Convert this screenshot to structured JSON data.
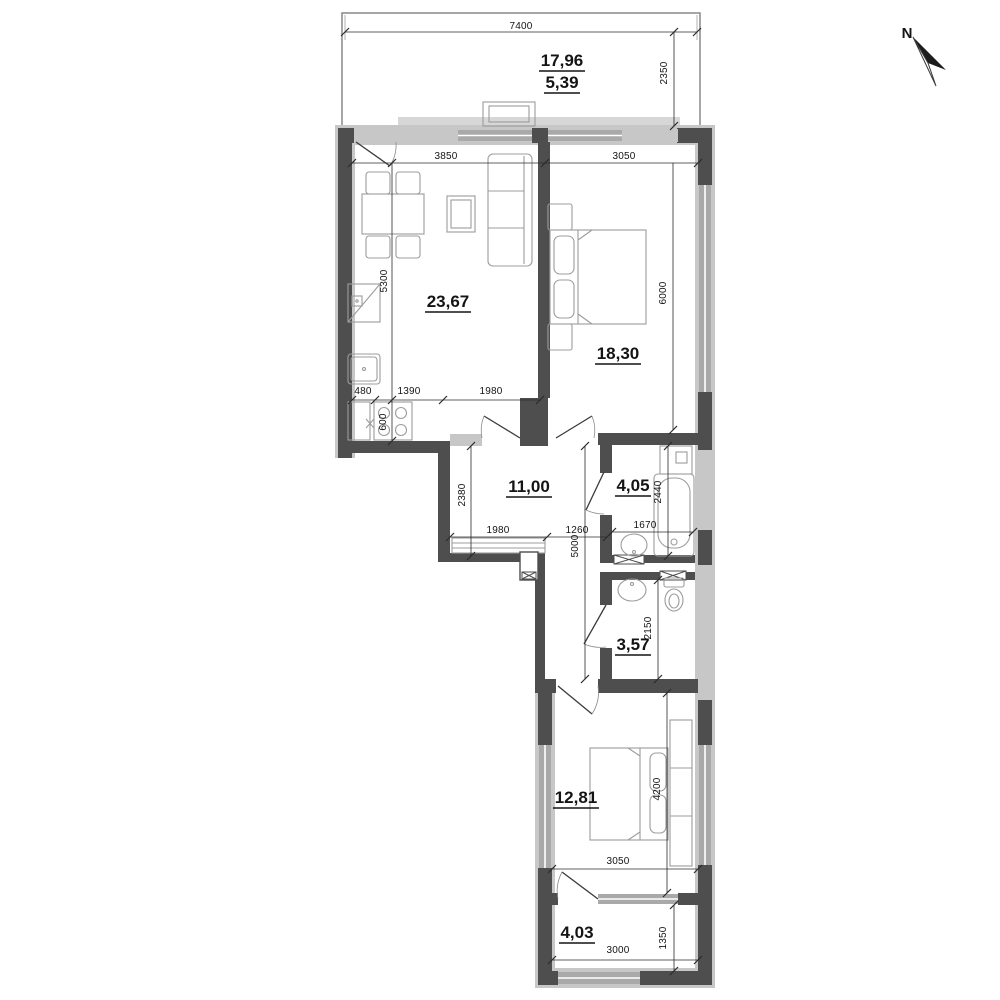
{
  "compass": {
    "label": "N"
  },
  "rooms": {
    "balcony_top": {
      "area": "17,96",
      "area_secondary": "5,39"
    },
    "living_kitchen": {
      "area": "23,67"
    },
    "bedroom1": {
      "area": "18,30"
    },
    "hallway": {
      "area": "11,00"
    },
    "bathroom": {
      "area": "4,05"
    },
    "wc": {
      "area": "3,57"
    },
    "bedroom2": {
      "area": "12,81"
    },
    "balcony_bottom": {
      "area": "4,03"
    }
  },
  "dims": {
    "balcony_width": "7400",
    "balcony_depth": "2350",
    "living_width": "3850",
    "bedroom1_width": "3050",
    "living_depth": "5300",
    "bedroom1_depth": "6000",
    "kitchen_seg_a": "480",
    "kitchen_seg_b": "1390",
    "kitchen_seg_c": "1980",
    "kitchen_depth": "600",
    "hall_depth": "2380",
    "hall_seg_a": "1980",
    "hall_seg_b": "1260",
    "bath_width": "1670",
    "bath_depth": "2440",
    "corridor_depth": "5000",
    "wc_depth": "2150",
    "bedroom2_depth": "4200",
    "bedroom2_width": "3050",
    "balcony2_width": "3000",
    "balcony2_depth": "1350"
  },
  "colors": {
    "wall_dark": "#4e4e4e",
    "wall_light": "#c7c7c7",
    "window_gray": "#a9a9a9",
    "background": "#ffffff"
  }
}
